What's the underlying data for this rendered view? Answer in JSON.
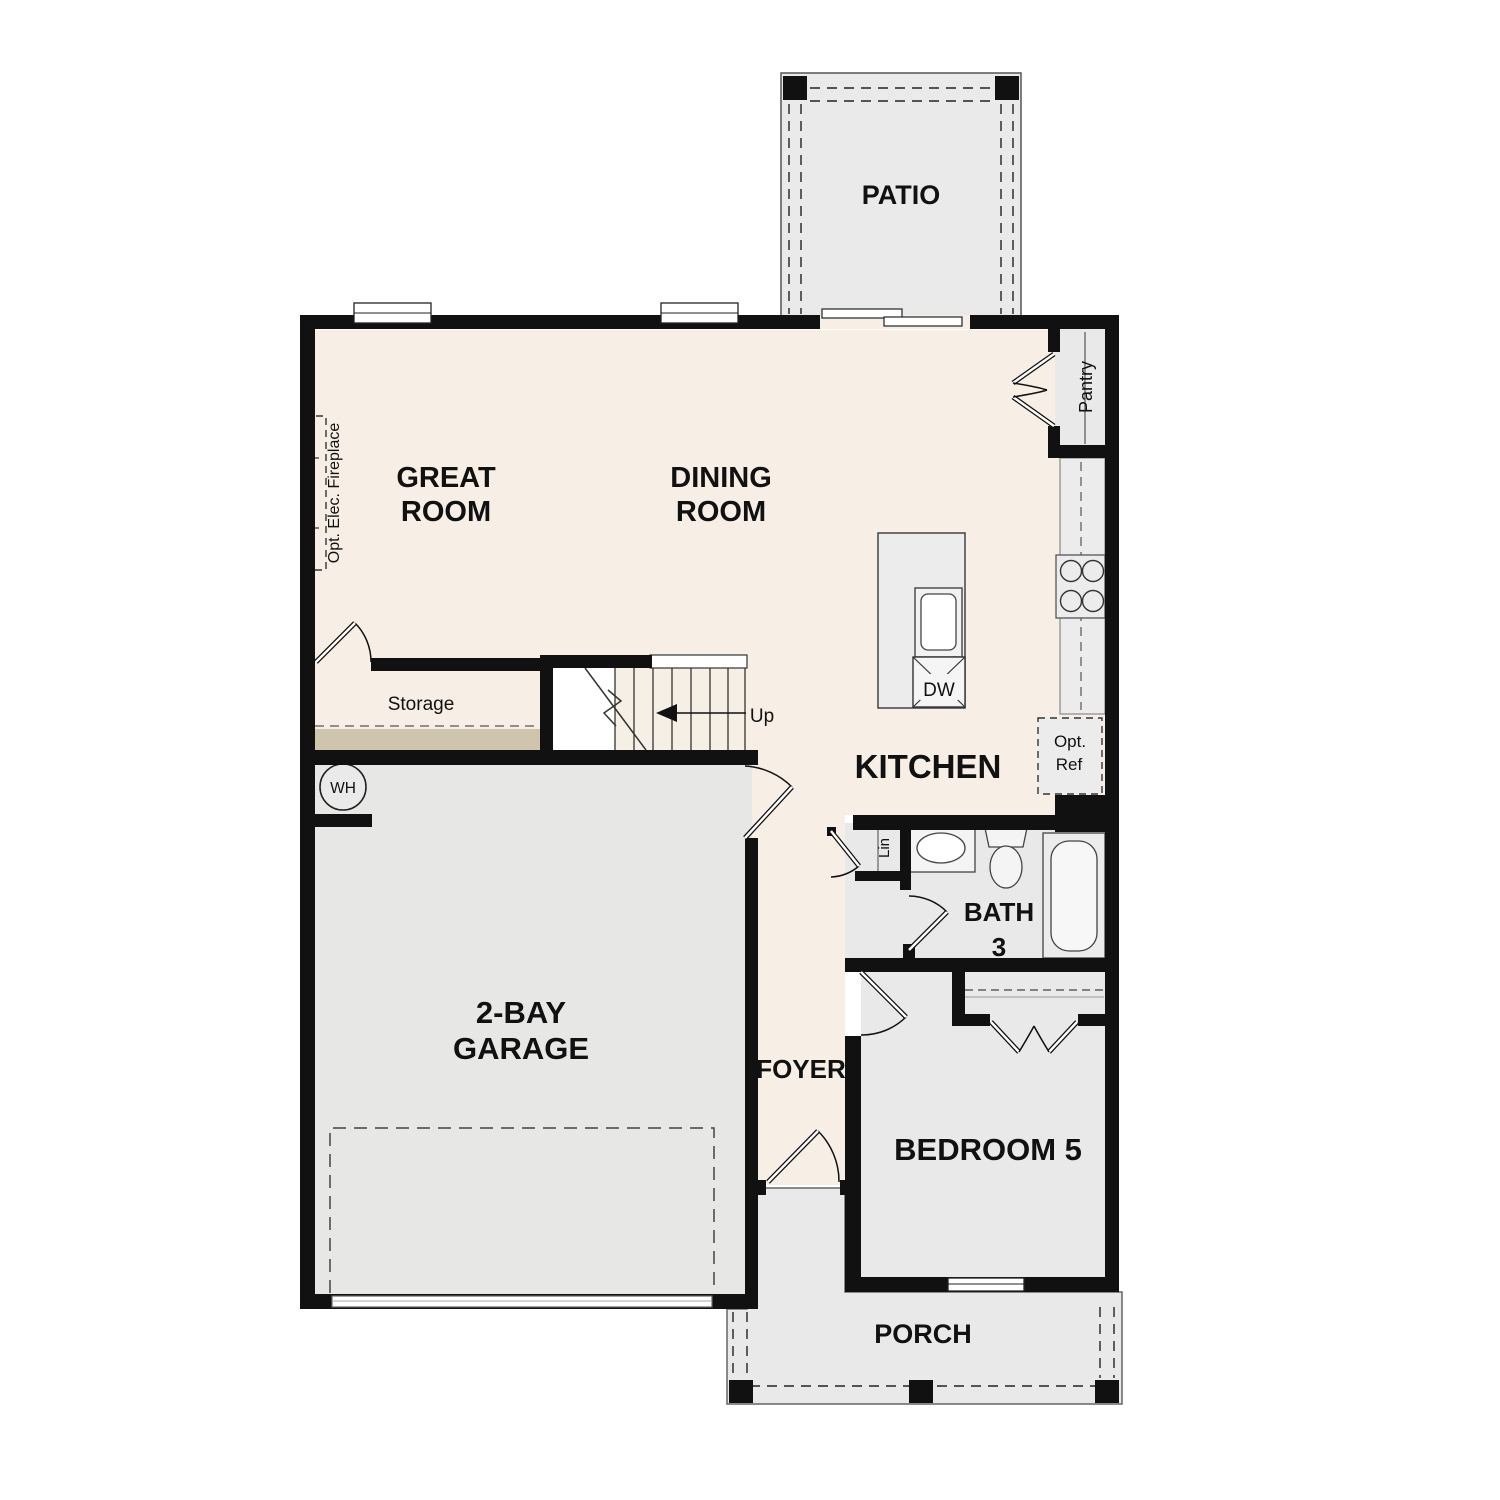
{
  "rooms": {
    "patio": {
      "label": "PATIO"
    },
    "great_room": {
      "line1": "GREAT",
      "line2": "ROOM"
    },
    "dining_room": {
      "line1": "DINING",
      "line2": "ROOM"
    },
    "kitchen": {
      "label": "KITCHEN"
    },
    "foyer": {
      "label": "FOYER"
    },
    "garage": {
      "line1": "2-BAY",
      "line2": "GARAGE"
    },
    "bedroom5": {
      "label": "BEDROOM 5"
    },
    "bath3": {
      "line1": "BATH",
      "line2": "3"
    },
    "porch": {
      "label": "PORCH"
    }
  },
  "features": {
    "storage": "Storage",
    "up": "Up",
    "water_heater": "WH",
    "dishwasher": "DW",
    "opt_ref_line1": "Opt.",
    "opt_ref_line2": "Ref",
    "linen": "Lin",
    "pantry": "Pantry",
    "fireplace": "Opt. Elec. Fireplace"
  },
  "colors": {
    "floor_cream": "#f7efe6",
    "area_gray": "#e9e9e9",
    "fixture_gray": "#ececec",
    "storage_tan": "#cfc4ac",
    "wall_black": "#111111",
    "outline_gray": "#555555"
  }
}
